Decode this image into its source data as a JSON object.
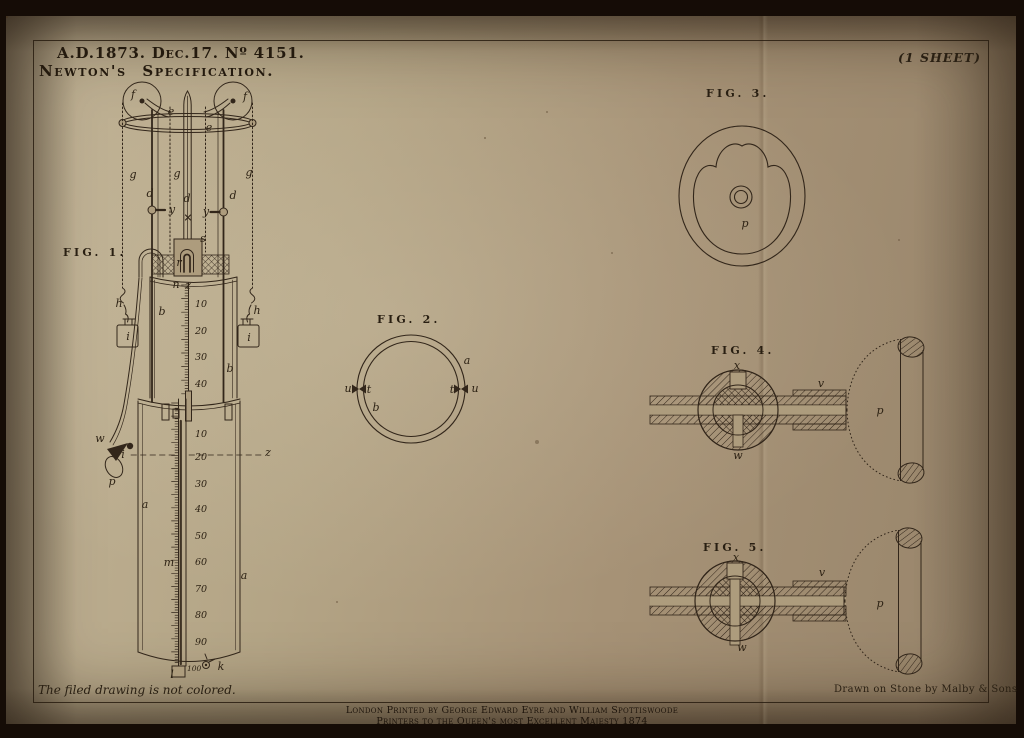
{
  "header": {
    "patent_ref": "A.D.1873. Dec.17. Nº 4151.",
    "title": "Newton's Specification.",
    "sheet_note": "(1 SHEET)"
  },
  "footer": {
    "filed_note": "The filed drawing is not colored.",
    "litho_credit": "Drawn on Stone by Malby & Sons",
    "imprint_line1": "London Printed by George Edward Eyre and William Spottiswoode",
    "imprint_line2": "Printers to the Queen's most Excellent Majesty 1874"
  },
  "colors": {
    "paper": "#ad9c7d",
    "ink": "#32261a",
    "background": "#150c06"
  },
  "figures": [
    {
      "name": "fig1",
      "caption": "FIG. 1.",
      "labels": [
        {
          "t": "FIG. 1.",
          "x": 63,
          "y": 256,
          "c": "f"
        },
        {
          "t": "f",
          "x": 133,
          "y": 98
        },
        {
          "t": "f",
          "x": 245,
          "y": 100
        },
        {
          "t": "e",
          "x": 171,
          "y": 115
        },
        {
          "t": "e",
          "x": 209,
          "y": 131
        },
        {
          "t": "g",
          "x": 133,
          "y": 178
        },
        {
          "t": "g",
          "x": 177,
          "y": 177
        },
        {
          "t": "g",
          "x": 249,
          "y": 176
        },
        {
          "t": "d",
          "x": 150,
          "y": 197
        },
        {
          "t": "d",
          "x": 187,
          "y": 202
        },
        {
          "t": "d",
          "x": 233,
          "y": 199
        },
        {
          "t": "y",
          "x": 172,
          "y": 213
        },
        {
          "t": "y",
          "x": 206,
          "y": 215
        },
        {
          "t": "s",
          "x": 203,
          "y": 242
        },
        {
          "t": "r",
          "x": 179,
          "y": 266
        },
        {
          "t": "n",
          "x": 176,
          "y": 288
        },
        {
          "t": "z",
          "x": 188,
          "y": 289
        },
        {
          "t": "b",
          "x": 162,
          "y": 315
        },
        {
          "t": "b",
          "x": 230,
          "y": 372
        },
        {
          "t": "h",
          "x": 119,
          "y": 307
        },
        {
          "t": "h",
          "x": 257,
          "y": 314
        },
        {
          "t": "i",
          "x": 128,
          "y": 340
        },
        {
          "t": "i",
          "x": 249,
          "y": 341
        },
        {
          "t": "w",
          "x": 100,
          "y": 442
        },
        {
          "t": "p",
          "x": 112,
          "y": 485
        },
        {
          "t": "i",
          "x": 123,
          "y": 458
        },
        {
          "t": "z",
          "x": 268,
          "y": 456
        },
        {
          "t": "a",
          "x": 145,
          "y": 508
        },
        {
          "t": "a",
          "x": 244,
          "y": 579
        },
        {
          "t": "m",
          "x": 169,
          "y": 566
        },
        {
          "t": "l",
          "x": 172,
          "y": 678
        },
        {
          "t": "k",
          "x": 221,
          "y": 670
        },
        {
          "t": "10",
          "x": 195,
          "y": 307,
          "c": "s"
        },
        {
          "t": "20",
          "x": 195,
          "y": 334,
          "c": "s"
        },
        {
          "t": "30",
          "x": 195,
          "y": 360,
          "c": "s"
        },
        {
          "t": "40",
          "x": 195,
          "y": 387,
          "c": "s"
        },
        {
          "t": "10",
          "x": 195,
          "y": 437,
          "c": "s"
        },
        {
          "t": "20",
          "x": 195,
          "y": 460,
          "c": "s"
        },
        {
          "t": "30",
          "x": 195,
          "y": 487,
          "c": "s"
        },
        {
          "t": "40",
          "x": 195,
          "y": 512,
          "c": "s"
        },
        {
          "t": "50",
          "x": 195,
          "y": 539,
          "c": "s"
        },
        {
          "t": "60",
          "x": 195,
          "y": 565,
          "c": "s"
        },
        {
          "t": "70",
          "x": 195,
          "y": 592,
          "c": "s"
        },
        {
          "t": "80",
          "x": 195,
          "y": 618,
          "c": "s"
        },
        {
          "t": "90",
          "x": 195,
          "y": 645,
          "c": "s"
        },
        {
          "t": "100",
          "x": 187,
          "y": 671,
          "c": "s2"
        }
      ]
    },
    {
      "name": "fig2",
      "caption": "FIG. 2.",
      "labels": [
        {
          "t": "FIG. 2.",
          "x": 377,
          "y": 323,
          "c": "f"
        },
        {
          "t": "a",
          "x": 467,
          "y": 364
        },
        {
          "t": "b",
          "x": 376,
          "y": 411
        },
        {
          "t": "u",
          "x": 348,
          "y": 392
        },
        {
          "t": "t",
          "x": 369,
          "y": 393
        },
        {
          "t": "t",
          "x": 452,
          "y": 393
        },
        {
          "t": "u",
          "x": 475,
          "y": 392
        }
      ]
    },
    {
      "name": "fig3",
      "caption": "FIG. 3.",
      "labels": [
        {
          "t": "FIG. 3.",
          "x": 706,
          "y": 97,
          "c": "f"
        },
        {
          "t": "p",
          "x": 745,
          "y": 227
        }
      ]
    },
    {
      "name": "fig4",
      "caption": "FIG. 4.",
      "labels": [
        {
          "t": "FIG. 4.",
          "x": 711,
          "y": 354,
          "c": "f"
        },
        {
          "t": "x",
          "x": 737,
          "y": 369
        },
        {
          "t": "w",
          "x": 738,
          "y": 459
        },
        {
          "t": "v",
          "x": 821,
          "y": 387
        },
        {
          "t": "p",
          "x": 880,
          "y": 414
        }
      ]
    },
    {
      "name": "fig5",
      "caption": "FIG. 5.",
      "labels": [
        {
          "t": "FIG. 5.",
          "x": 703,
          "y": 551,
          "c": "f"
        },
        {
          "t": "x",
          "x": 736,
          "y": 561
        },
        {
          "t": "w",
          "x": 742,
          "y": 651
        },
        {
          "t": "v",
          "x": 822,
          "y": 576
        },
        {
          "t": "p",
          "x": 880,
          "y": 607
        }
      ]
    }
  ]
}
